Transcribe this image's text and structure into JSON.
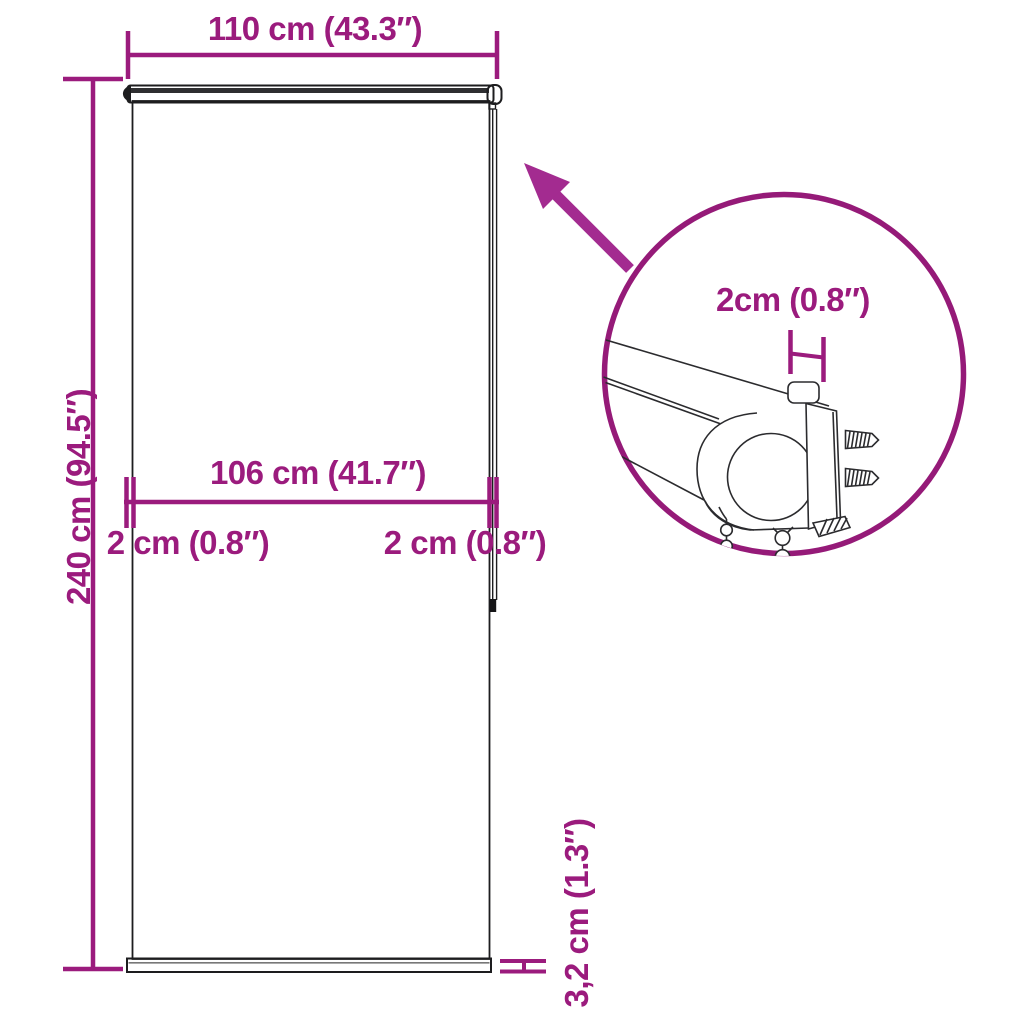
{
  "page": {
    "background": "#ffffff",
    "kind": "roller-blind dimension diagram"
  },
  "colors": {
    "accent": "#9b1b7d",
    "detail_circle": "#951a78",
    "arrow": "#a32b90",
    "line_art": "#1d1d1f"
  },
  "labels": {
    "total_width": "110 cm (43.3″)",
    "total_height": "240 cm (94.5″)",
    "fabric_width": "106 cm (41.7″)",
    "left_offset": "2 cm (0.8″)",
    "right_offset": "2 cm (0.8″)",
    "bottom_bar_height": "3,2 cm (1.3″)",
    "bracket_depth": "2cm (0.8″)"
  }
}
